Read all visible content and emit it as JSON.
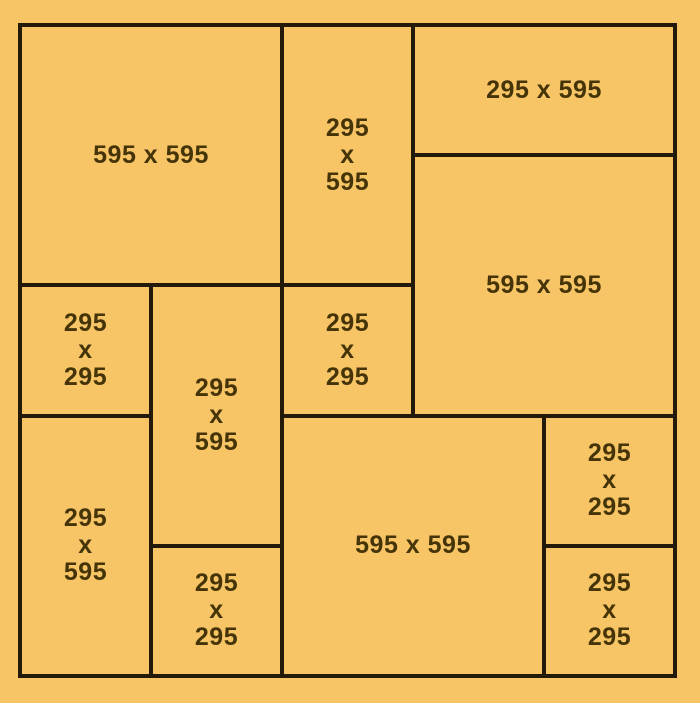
{
  "diagram": {
    "title": "panel-cutting-layout",
    "colors": {
      "background": "#f7c566",
      "cut_line": "#231a09",
      "label_text": "#463409"
    },
    "pieces": [
      {
        "size": "595 x 595",
        "label": "595 x 595"
      },
      {
        "size": "295 x 595",
        "label": "295\nx\n595"
      },
      {
        "size": "295 x 595",
        "label": "295 x 595"
      },
      {
        "size": "595 x 595",
        "label": "595 x 595"
      },
      {
        "size": "295 x 295",
        "label": "295\nx\n295"
      },
      {
        "size": "295 x 595",
        "label": "295\nx\n595"
      },
      {
        "size": "295 x 295",
        "label": "295\nx\n295"
      },
      {
        "size": "295 x 595",
        "label": "295\nx\n595"
      },
      {
        "size": "295 x 295",
        "label": "295\nx\n295"
      },
      {
        "size": "595 x 595",
        "label": "595 x 595"
      },
      {
        "size": "295 x 295",
        "label": "295\nx\n295"
      },
      {
        "size": "295 x 295",
        "label": "295\nx\n295"
      }
    ]
  }
}
